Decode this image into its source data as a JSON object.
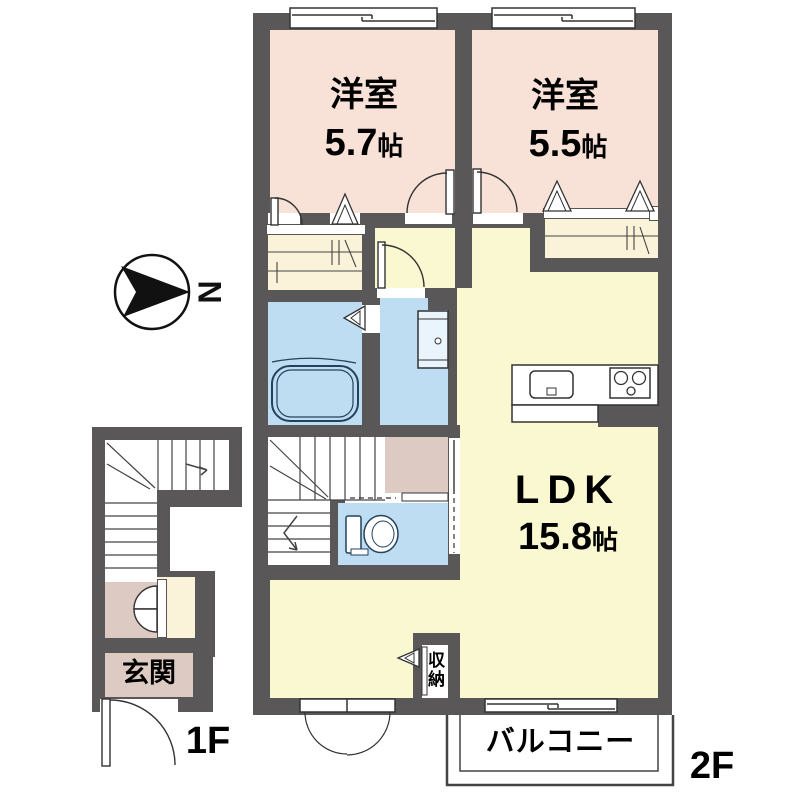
{
  "colors": {
    "wall": "#595757",
    "bedroom": "#f8e2d7",
    "ldk": "#faf8d0",
    "closet": "#faf3da",
    "wet": "#bedcf2",
    "entry": "#ddcbc3",
    "line": "#333333",
    "fixture": "#23425c"
  },
  "rooms": {
    "bedroom1": {
      "name": "洋室",
      "size": "5.7",
      "unit": "帖"
    },
    "bedroom2": {
      "name": "洋室",
      "size": "5.5",
      "unit": "帖"
    },
    "ldk": {
      "name": "LDK",
      "size": "15.8",
      "unit": "帖"
    },
    "entrance": {
      "name": "玄関"
    },
    "balcony": {
      "name": "バルコニー"
    },
    "storage": {
      "name": "収納"
    }
  },
  "floors": {
    "lower": "1F",
    "upper": "2F"
  },
  "compass": {
    "north": "N"
  }
}
